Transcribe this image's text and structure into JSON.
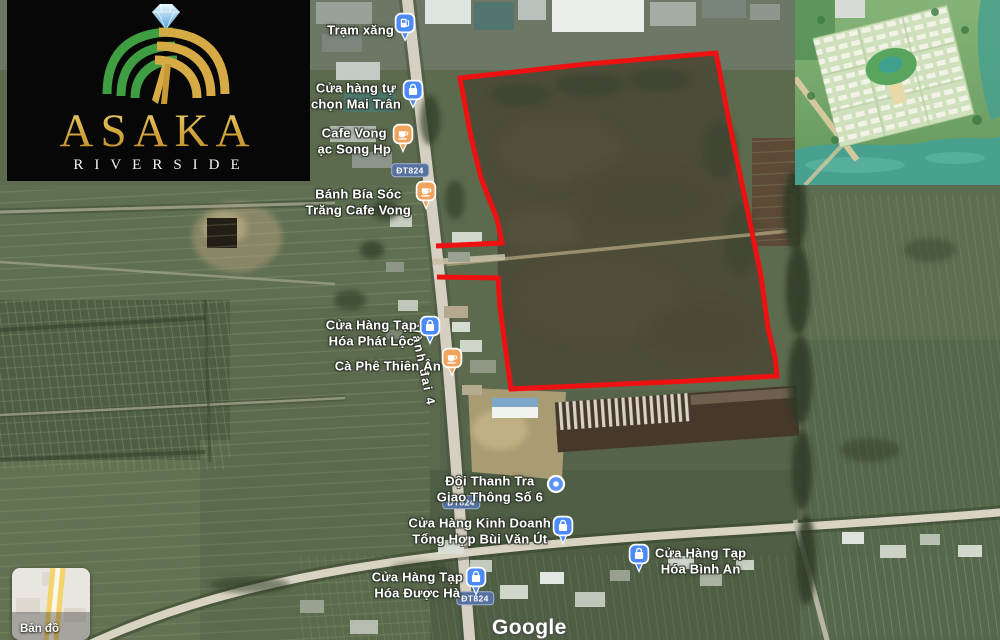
{
  "logo": {
    "brand": "ASAKA",
    "tagline": "RIVERSIDE"
  },
  "map": {
    "attribution": "Google",
    "map_type_label": "Bản đồ",
    "road_badge_text": "ĐT824",
    "road_badges": [
      {
        "x": 410,
        "y": 170
      },
      {
        "x": 461,
        "y": 502
      },
      {
        "x": 475,
        "y": 598
      }
    ],
    "road_name": "Vành đai 4",
    "places": [
      {
        "name": "tram-xang",
        "lines": [
          "Trạm xăng"
        ],
        "pin": "gas",
        "x": 405,
        "y": 41,
        "label_x": 394,
        "label_y": 30,
        "side": "left"
      },
      {
        "name": "mai-tran",
        "lines": [
          "Cửa hàng tự",
          "chọn Mai Trân"
        ],
        "pin": "shop",
        "x": 413,
        "y": 108,
        "label_x": 401,
        "label_y": 96,
        "side": "left"
      },
      {
        "name": "cafe-vong",
        "lines": [
          "Cafe Vong",
          "ạc Song Hp"
        ],
        "pin": "cafe",
        "x": 403,
        "y": 152,
        "label_x": 391,
        "label_y": 141,
        "side": "left"
      },
      {
        "name": "banh-bia",
        "lines": [
          "Bánh Bía Sóc",
          "Trăng Cafe Vong"
        ],
        "pin": "cafe",
        "x": 426,
        "y": 209,
        "label_x": 411,
        "label_y": 202,
        "side": "left"
      },
      {
        "name": "phat-loc",
        "lines": [
          "Cửa Hàng Tạp",
          "Hóa Phát Lộc"
        ],
        "pin": "shop",
        "x": 430,
        "y": 344,
        "label_x": 417,
        "label_y": 333,
        "side": "left"
      },
      {
        "name": "thien-an",
        "lines": [
          "Cà Phê Thiên Ân"
        ],
        "pin": "cafe",
        "x": 452,
        "y": 376,
        "label_x": 441,
        "label_y": 366,
        "side": "left"
      },
      {
        "name": "doi-thanh-tra",
        "lines": [
          "Đội Thanh Tra",
          "Giao Thông Số 6"
        ],
        "pin": "dot",
        "x": 556,
        "y": 484,
        "label_x": 543,
        "label_y": 489,
        "side": "left"
      },
      {
        "name": "bui-van-ut",
        "lines": [
          "Cửa Hàng Kinh Doanh",
          "Tổng Hợp Bùi Văn Út"
        ],
        "pin": "shop",
        "x": 563,
        "y": 544,
        "label_x": 551,
        "label_y": 531,
        "side": "left"
      },
      {
        "name": "duoc-ha",
        "lines": [
          "Cửa Hàng Tạp",
          "Hóa Được Hà"
        ],
        "pin": "shop",
        "x": 476,
        "y": 595,
        "label_x": 463,
        "label_y": 585,
        "side": "left"
      },
      {
        "name": "binh-an",
        "lines": [
          "Cửa Hàng Tạp",
          "Hóa Bình An"
        ],
        "pin": "shop",
        "x": 639,
        "y": 572,
        "label_x": 655,
        "label_y": 561,
        "side": "right"
      }
    ]
  },
  "colors": {
    "plot_outline": "#ee1111",
    "pin_blue": "#4b8af8",
    "pin_orange": "#f0a35c",
    "pin_dot_blue": "#5a95f5",
    "badge_fill": "#55719f",
    "badge_border": "#9db1d4"
  }
}
